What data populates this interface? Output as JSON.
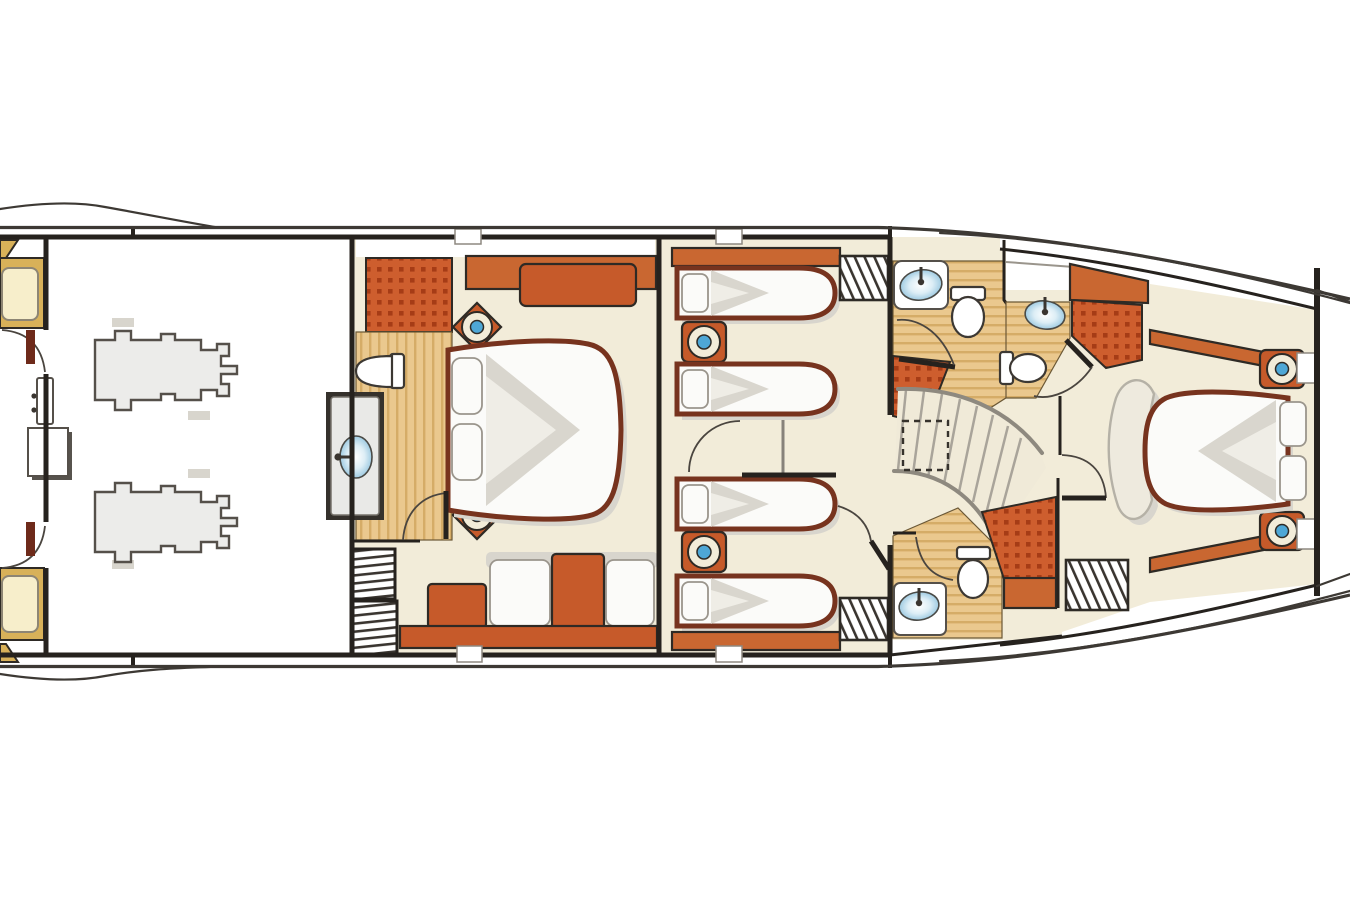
{
  "plan": {
    "type": "yacht-deck-arrangement",
    "deck": "lower-deck",
    "description": "Motor yacht lower deck arrangement plan: aft crew quarters, engine room with twin engines, full-beam master stateroom with ensuite bathroom and sofa, two twin guest cabins off a central corridor, guest bathrooms with showers, a curved companionway staircase, and a forward VIP stateroom with island bed",
    "rooms": [
      {
        "id": "crew-quarters",
        "label": "Crew quarters (aft)"
      },
      {
        "id": "engine-room",
        "label": "Engine room"
      },
      {
        "id": "master-stateroom",
        "label": "Master stateroom"
      },
      {
        "id": "master-bathroom",
        "label": "Master bathroom"
      },
      {
        "id": "guest-cabin-port",
        "label": "Twin guest cabin (port)"
      },
      {
        "id": "guest-cabin-starboard",
        "label": "Twin guest cabin (starboard)"
      },
      {
        "id": "bathroom-port",
        "label": "Guest bathroom (port)"
      },
      {
        "id": "bathroom-forward",
        "label": "Forward bathroom"
      },
      {
        "id": "bathroom-starboard",
        "label": "Guest bathroom (starboard)"
      },
      {
        "id": "companionway",
        "label": "Curved staircase"
      },
      {
        "id": "vip-stateroom",
        "label": "VIP stateroom (forward)"
      },
      {
        "id": "chain-locker",
        "label": "Chain locker (bow)"
      }
    ],
    "fixtures": {
      "double_beds": 2,
      "single_beds": 4,
      "crew_berths": 2,
      "engines": 2,
      "toilets": 4,
      "sinks": 5,
      "showers": 4,
      "bedside_lamps": 6,
      "staircases": 2,
      "sofas": 1,
      "louver_vents": 3
    }
  },
  "colors": {
    "outline": "#2e2a25",
    "wall": "#26221e",
    "hullLine": "#3d3934",
    "cream": "#f2ecd9",
    "creamLight": "#f0ead8",
    "wood": "#eac88e",
    "woodStripe": "#d5ac67",
    "tile": "#ce5e2e",
    "tileDot": "#a63c16",
    "cabinetOrange": "#c96731",
    "furnitureOrange": "#c65a2a",
    "bedFrame": "#77331e",
    "mattress": "#fbfbf9",
    "shadow": "#d8d5cd",
    "blanket": "#d9d6ce",
    "blanketLight": "#efede6",
    "lampBlue": "#4ea7d6",
    "gold": "#d8b159",
    "goldLight": "#f7eecb",
    "engineGray": "#ececea",
    "engineStroke": "#55504a",
    "doorMaroon": "#6e2a1a",
    "stepGray": "#a9a49a",
    "railGray": "#8e897f"
  }
}
